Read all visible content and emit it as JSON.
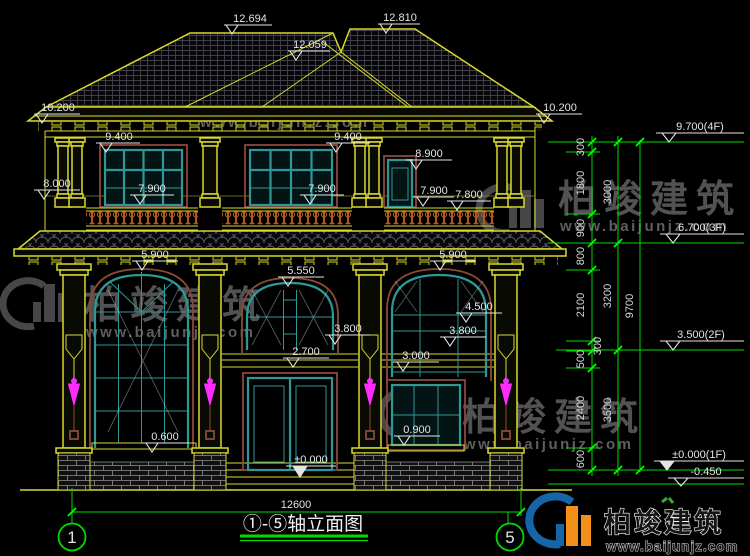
{
  "labels": {
    "roof_left": "12.694",
    "roof_right": "12.810",
    "roof_valley": "12.059",
    "eave_left": "10.200",
    "eave_right": "10.200",
    "win3_left": "9.400",
    "win3_mid": "9.400",
    "door3": "8.900",
    "molding": "8.000",
    "rail1": "7.900",
    "rail2": "7.900",
    "rail3": "7.900",
    "rail4": "7.800",
    "arch_left": "5.900",
    "arch_mid": "5.550",
    "arch_right": "5.900",
    "win2_right": "4.500",
    "transom_left": "3.800",
    "transom_right": "3.800",
    "sill2_right": "3.000",
    "door1": "2.700",
    "sill1_left": "0.600",
    "sill1_right": "0.900",
    "floor0": "±0.000"
  },
  "chain": {
    "c1": [
      "300",
      "1800",
      "900",
      "800",
      "2100",
      "300",
      "500",
      "2400",
      "600"
    ],
    "c2": [
      "3000",
      "3200",
      "3500"
    ],
    "c3": "9700",
    "flags": [
      "9.700(4F)",
      "6.700(3F)",
      "3.500(2F)",
      "±0.000(1F)",
      "-0.450"
    ]
  },
  "footer": {
    "overall": "12600",
    "title": "①-⑤轴立面图",
    "axis_left": "1",
    "axis_right": "5"
  },
  "watermark": {
    "brand": "柏竣建筑",
    "url": "www.baijunjz.com"
  }
}
